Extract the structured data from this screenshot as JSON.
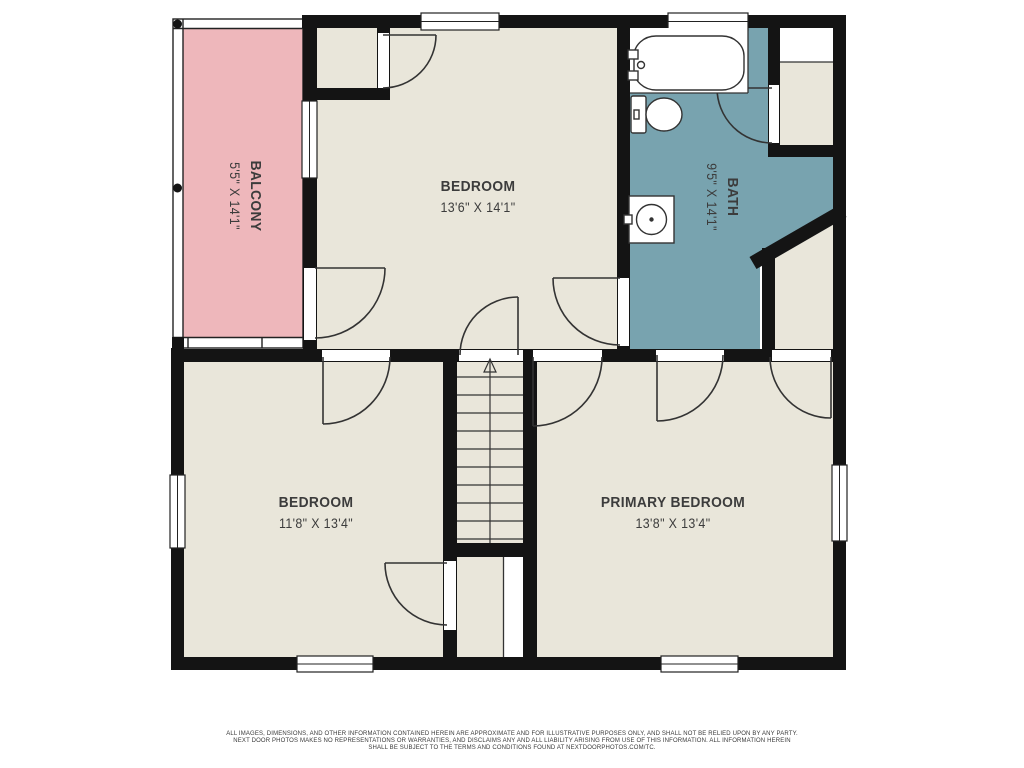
{
  "plan": {
    "title": "second floor plan",
    "rooms": {
      "balcony": {
        "name": "BALCONY",
        "dims": "5'5\" X 14'1\""
      },
      "bedroom_upper": {
        "name": "BEDROOM",
        "dims": "13'6\" X 14'1\""
      },
      "bath": {
        "name": "BATH",
        "dims": "9'5\" X 14'1\""
      },
      "bedroom_lower": {
        "name": "BEDROOM",
        "dims": "11'8\" X 13'4\""
      },
      "primary": {
        "name": "PRIMARY BEDROOM",
        "dims": "13'8\" X 13'4\""
      }
    },
    "stairs": {
      "direction_arrow": "up",
      "treads": 11
    },
    "fixtures": [
      "bathtub",
      "toilet",
      "sink"
    ]
  },
  "colors": {
    "floor": "#e9e6da",
    "balcony": "#eeb7bb",
    "bath": "#78a3af",
    "wall": "#141414",
    "line": "#333333",
    "label": "#3c3c3c",
    "background": "#ffffff"
  },
  "disclaimer": {
    "line1": "ALL IMAGES, DIMENSIONS, AND OTHER INFORMATION CONTAINED HEREIN ARE APPROXIMATE AND FOR ILLUSTRATIVE PURPOSES ONLY, AND SHALL NOT BE RELIED UPON BY ANY PARTY.",
    "line2": "NEXT DOOR PHOTOS MAKES NO REPRESENTATIONS OR WARRANTIES, AND DISCLAIMS ANY AND ALL LIABILITY ARISING FROM USE OF THIS INFORMATION. ALL INFORMATION HEREIN",
    "line3": "SHALL BE SUBJECT TO THE TERMS AND CONDITIONS FOUND AT NEXTDOORPHOTOS.COM/TC."
  }
}
